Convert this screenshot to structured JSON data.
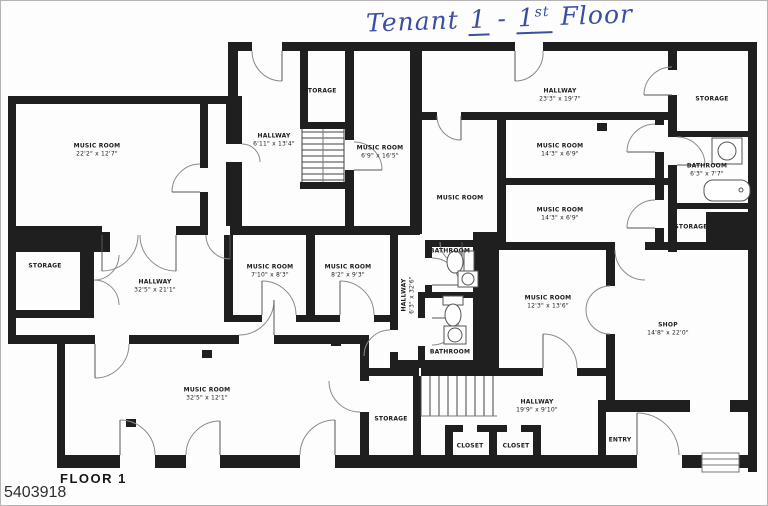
{
  "title_annotation": {
    "prefix": "Tenant",
    "tenant_number": "1",
    "separator": "-",
    "floor_number": "1",
    "floor_suffix": "st",
    "suffix": "Floor"
  },
  "footer": {
    "floor_label": "FLOOR 1",
    "photo_id": "5403918"
  },
  "colors": {
    "ink_blue": "#3d4da0",
    "wall_black": "#1f1f1f",
    "paper_white": "#fdfdfd"
  },
  "rooms": [
    {
      "name": "MUSIC ROOM",
      "dims": "22'2\" x 12'7\""
    },
    {
      "name": "STORAGE",
      "dims": ""
    },
    {
      "name": "HALLWAY",
      "dims": "6'11\" x 13'4\""
    },
    {
      "name": "MUSIC ROOM",
      "dims": "6'9\" x 16'5\""
    },
    {
      "name": "HALLWAY",
      "dims": "23'3\" x 19'7\""
    },
    {
      "name": "MUSIC ROOM",
      "dims": "14'3\" x 6'9\""
    },
    {
      "name": "MUSIC ROOM",
      "dims": ""
    },
    {
      "name": "MUSIC ROOM",
      "dims": "14'3\" x 6'9\""
    },
    {
      "name": "STORAGE",
      "dims": ""
    },
    {
      "name": "BATHROOM",
      "dims": "6'3\" x 7'7\""
    },
    {
      "name": "STORAGE",
      "dims": ""
    },
    {
      "name": "STORAGE",
      "dims": ""
    },
    {
      "name": "HALLWAY",
      "dims": "32'5\" x 21'1\""
    },
    {
      "name": "MUSIC ROOM",
      "dims": "7'10\" x 8'3\""
    },
    {
      "name": "MUSIC ROOM",
      "dims": "8'2\" x 9'3\""
    },
    {
      "name": "BATHROOM",
      "dims": ""
    },
    {
      "name": "HALLWAY",
      "dims": "6'3\" x 32'6\""
    },
    {
      "name": "BATHROOM",
      "dims": ""
    },
    {
      "name": "MUSIC ROOM",
      "dims": "12'3\" x 13'6\""
    },
    {
      "name": "SHOP",
      "dims": "14'8\" x 22'0\""
    },
    {
      "name": "MUSIC ROOM",
      "dims": "32'5\" x 12'1\""
    },
    {
      "name": "STORAGE",
      "dims": ""
    },
    {
      "name": "HALLWAY",
      "dims": "19'9\" x 9'10\""
    },
    {
      "name": "CLOSET",
      "dims": ""
    },
    {
      "name": "CLOSET",
      "dims": ""
    },
    {
      "name": "ENTRY",
      "dims": ""
    }
  ]
}
